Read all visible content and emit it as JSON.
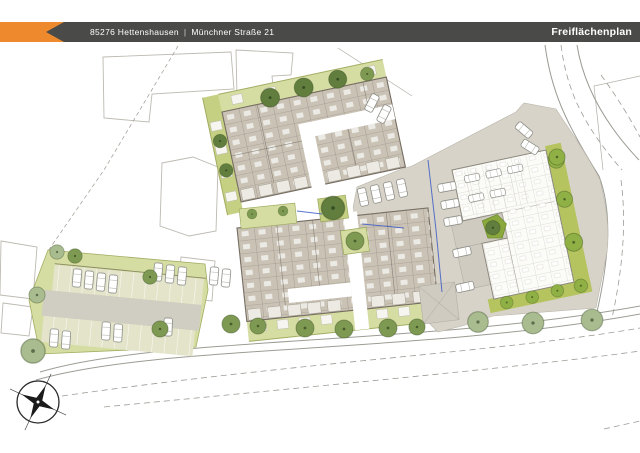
{
  "header": {
    "zip_city": "85276 Hettenshausen",
    "separator": "|",
    "street": "Münchner Straße 21",
    "title": "Freiflächenplan"
  },
  "icons": {
    "compass": "compass-rose-north-arrow"
  },
  "colors": {
    "accent": "#ee8a2d",
    "bar": "#4a4a48",
    "beige": "#d7d3c8",
    "plaza": "#cfcbc1",
    "green_light": "#d6dda2",
    "green_mid": "#c6d083",
    "green_bright": "#b5c45f",
    "hedge": "#a3ad62",
    "stall": "#e4e4cb",
    "drive": "#d0cdc2",
    "room": "#c9c2b5",
    "wall": "#746c60",
    "building_white": "#fbfbf8",
    "building_line": "#8e8a80",
    "road_line": "#9c9c95",
    "neighbor_line": "#bdbab2",
    "tree_garden": "#7e9a52",
    "tree_garden_dark": "#617e3e",
    "tree_street": "#a9bc90",
    "tree_bright": "#8fb045",
    "blue": "#3c5cc5",
    "compass": "#1b1b1b"
  }
}
